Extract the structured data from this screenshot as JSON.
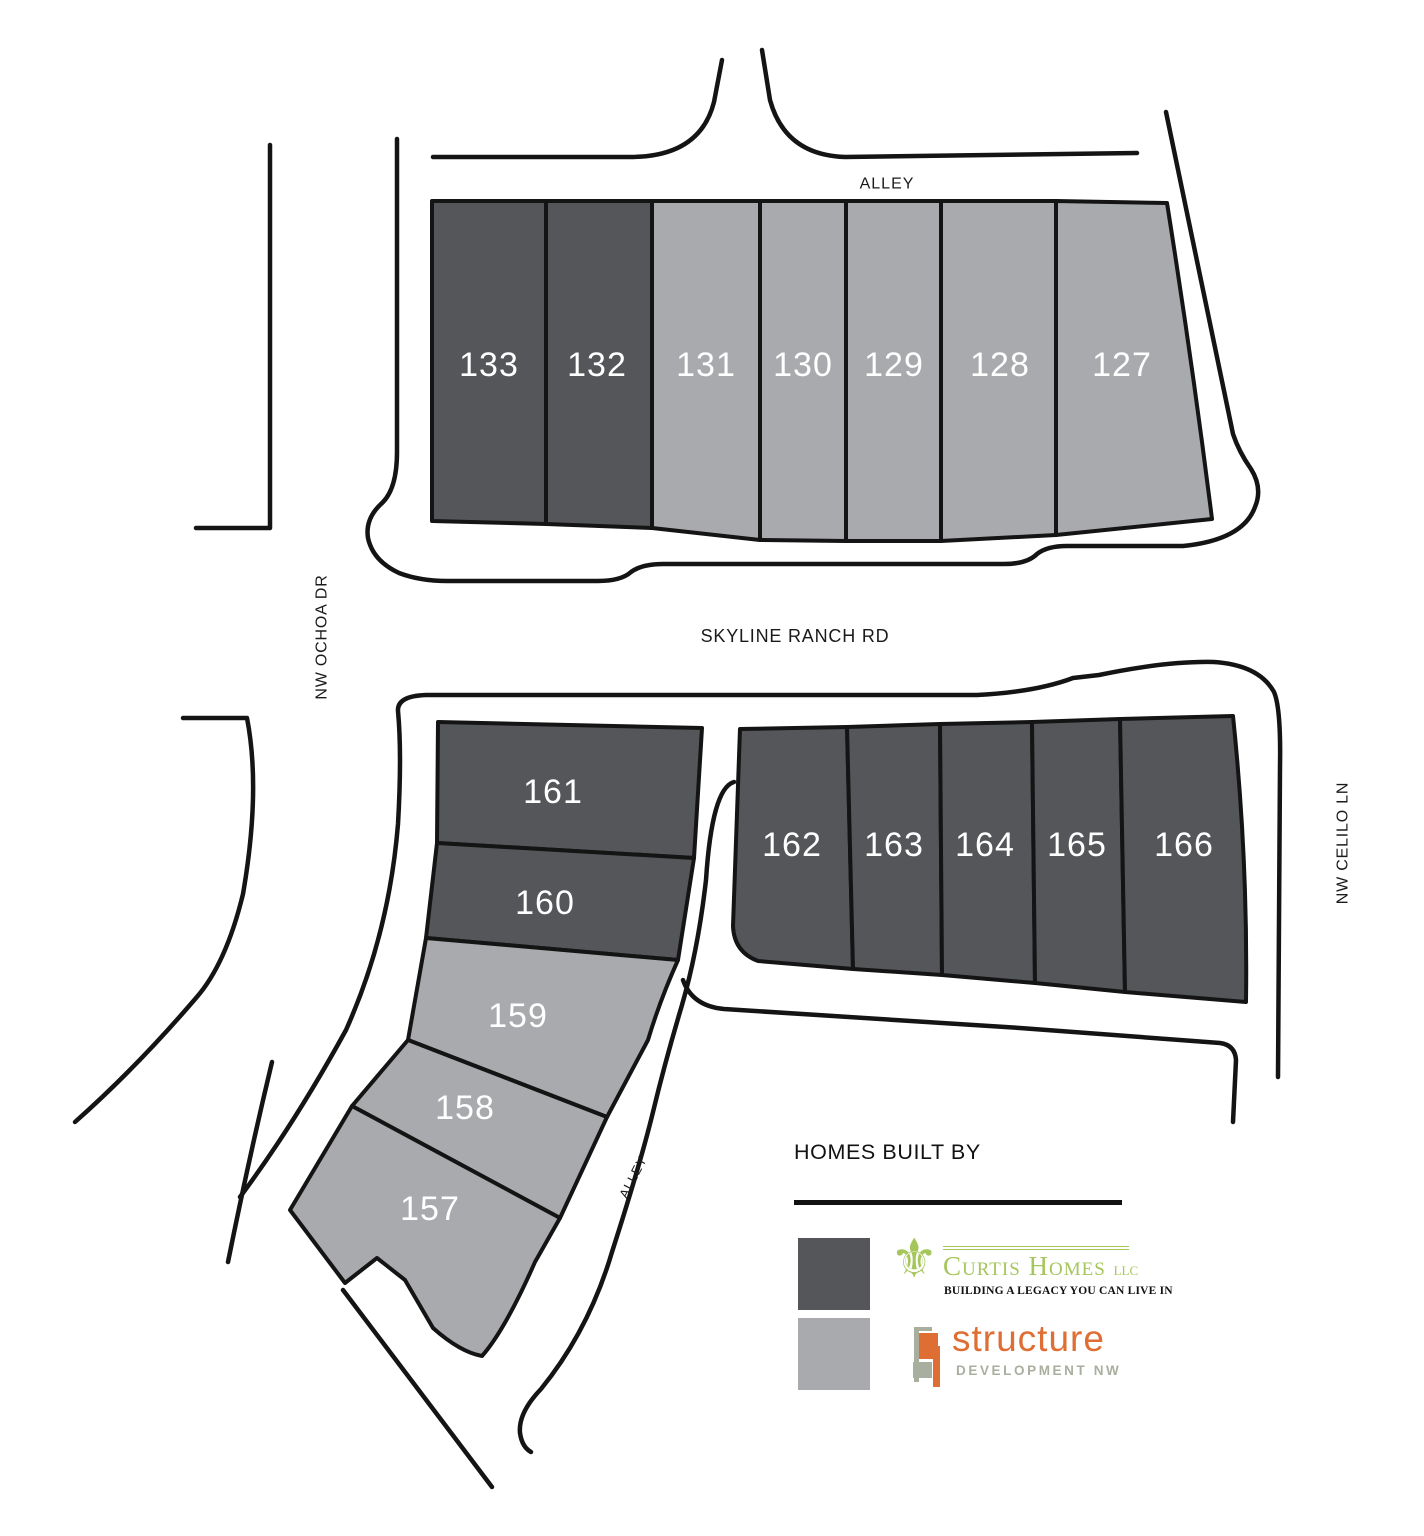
{
  "colors": {
    "curtis_lot": "#545659",
    "structure_lot": "#A8AAAD",
    "line": "#141414",
    "lot_label": "#FFFFFF",
    "street_label": "#1A1A1A",
    "curtis_green": "#A4C65B",
    "structure_orange": "#DF6E35",
    "structure_sage": "#A9AF9E"
  },
  "map": {
    "street_labels": [
      {
        "id": "alley-top",
        "text": "ALLEY",
        "x": 887,
        "y": 184,
        "rot": 0,
        "size": 16,
        "ls": 1
      },
      {
        "id": "skyline-ranch-rd",
        "text": "SKYLINE RANCH RD",
        "x": 795,
        "y": 636,
        "rot": 0,
        "size": 18,
        "ls": 0.8
      },
      {
        "id": "nw-ochoa-dr",
        "text": "NW OCHOA DR",
        "x": 322,
        "y": 637,
        "rot": -90,
        "size": 16,
        "ls": 0.8
      },
      {
        "id": "nw-celilo-ln",
        "text": "NW CELILO LN",
        "x": 1343,
        "y": 843,
        "rot": -90,
        "size": 16,
        "ls": 0.8
      },
      {
        "id": "alley-diagonal",
        "text": "ALLEY",
        "x": 633,
        "y": 1177,
        "rot": -63,
        "size": 13,
        "ls": 1
      }
    ],
    "roads": [
      {
        "name": "ochoa-west-edge",
        "d": "M270,145 L270,528 L196,528"
      },
      {
        "name": "alley-west-skyline-north-celilo-diag",
        "d": "M397,139 L397,452 Q397,490 381,504 Q365,519 368,538 Q373,561 399,573 Q420,581 447,581 L598,581 Q621,581 631,572 Q642,564 663,564 L1004,564 Q1027,564 1037,554 Q1047,546 1067,546 L1183,546 Q1243,540 1255,507 Q1263,488 1251,469 Q1239,452 1233,434 L1166,112"
      },
      {
        "name": "alley-north-edge-west",
        "d": "M433,157 L630,157 Q700,157 714,102 L722,60"
      },
      {
        "name": "alley-north-edge-east",
        "d": "M762,50 L770,100 Q785,155 845,157 L1137,153"
      },
      {
        "name": "skyline-south-celilo-west",
        "d": "M240,1197 Q295,1123 346,1030 Q389,934 398,824 Q402,754 398,711 Q397,696 426,695 L977,695 Q1036,692 1073,678 L1099,675 Q1166,661 1214,662 Q1259,665 1274,692 Q1281,708 1280,766 L1278,1077"
      },
      {
        "name": "ochoa-sw-arc-short",
        "d": "M272,1062 Q249,1158 228,1262"
      },
      {
        "name": "ochoa-sw-arc-inner",
        "d": "M183,718 L247,718 Q261,790 243,894 Q226,964 196,998 Q136,1068 75,1122"
      },
      {
        "name": "alley-east-edge",
        "d": "M734,782 Q712,788 706,880 Q698,950 682,1005 Q665,1062 653,1112 Q640,1165 612,1252 Q589,1330 541,1389 Q518,1413 520,1433 Q522,1447 531,1452"
      },
      {
        "name": "south-street-north-edge",
        "d": "M683,980 Q692,1006 724,1009 L1020,1028 L1220,1043 Q1235,1045 1236,1060 L1233,1122"
      },
      {
        "name": "alley-sw-continuation",
        "d": "M343,1290 L492,1487"
      }
    ],
    "lots": [
      {
        "number": "133",
        "builder": "curtis",
        "lx": 489,
        "ly": 365,
        "d": "M432,201 L546,201 L546,524 L432,521 Z"
      },
      {
        "number": "132",
        "builder": "curtis",
        "lx": 597,
        "ly": 365,
        "d": "M546,201 L652,201 L652,528 L546,524 Z"
      },
      {
        "number": "131",
        "builder": "structure",
        "lx": 706,
        "ly": 365,
        "d": "M652,201 L760,201 L760,540 L652,528 Z"
      },
      {
        "number": "130",
        "builder": "structure",
        "lx": 803,
        "ly": 365,
        "d": "M760,201 L846,201 L846,541 L760,540 Z"
      },
      {
        "number": "129",
        "builder": "structure",
        "lx": 894,
        "ly": 365,
        "d": "M846,201 L941,201 L941,541 L846,541 Z"
      },
      {
        "number": "128",
        "builder": "structure",
        "lx": 1000,
        "ly": 365,
        "d": "M941,201 L1056,201 L1056,535 L941,541 Z"
      },
      {
        "number": "127",
        "builder": "structure",
        "lx": 1122,
        "ly": 365,
        "d": "M1056,201 L1167,203 Q1192,360 1212,519 L1056,535 Z"
      },
      {
        "number": "161",
        "builder": "curtis",
        "lx": 553,
        "ly": 792,
        "d": "M438,722 L702,728 L694,858 L437,843 Z"
      },
      {
        "number": "160",
        "builder": "curtis",
        "lx": 545,
        "ly": 903,
        "d": "M437,843 L694,858 L678,960 L426,938 Z"
      },
      {
        "number": "159",
        "builder": "structure",
        "lx": 518,
        "ly": 1016,
        "d": "M426,938 L678,960 Q660,1000 648,1040 L607,1117 L408,1040 Z"
      },
      {
        "number": "158",
        "builder": "structure",
        "lx": 465,
        "ly": 1108,
        "d": "M408,1040 L607,1117 L560,1218 L352,1106 Z"
      },
      {
        "number": "157",
        "builder": "structure",
        "lx": 430,
        "ly": 1209,
        "d": "M352,1106 L560,1218 L535,1262 Q505,1330 482,1356 Q460,1352 433,1328 L405,1280 L377,1258 L345,1283 L290,1210 Q320,1160 352,1106 Z"
      },
      {
        "number": "162",
        "builder": "curtis",
        "lx": 792,
        "ly": 845,
        "d": "M740,729 L847,727 L853,969 L758,961 Q734,952 733,926 Z"
      },
      {
        "number": "163",
        "builder": "curtis",
        "lx": 894,
        "ly": 845,
        "d": "M847,727 L940,724 L942,975 L853,969 Z"
      },
      {
        "number": "164",
        "builder": "curtis",
        "lx": 985,
        "ly": 845,
        "d": "M940,724 L1032,722 L1035,983 L942,975 Z"
      },
      {
        "number": "165",
        "builder": "curtis",
        "lx": 1077,
        "ly": 845,
        "d": "M1032,722 L1120,719 L1125,992 L1035,983 Z"
      },
      {
        "number": "166",
        "builder": "curtis",
        "lx": 1184,
        "ly": 845,
        "d": "M1120,719 L1233,716 Q1248,860 1246,1002 L1125,992 Z"
      }
    ]
  },
  "legend": {
    "title": "HOMES BUILT BY",
    "curtis": {
      "name": "Curtis Homes",
      "suffix": "LLC",
      "tagline": "BUILDING A LEGACY YOU CAN LIVE IN"
    },
    "structure": {
      "name": "structure",
      "sub": "DEVELOPMENT NW"
    }
  }
}
